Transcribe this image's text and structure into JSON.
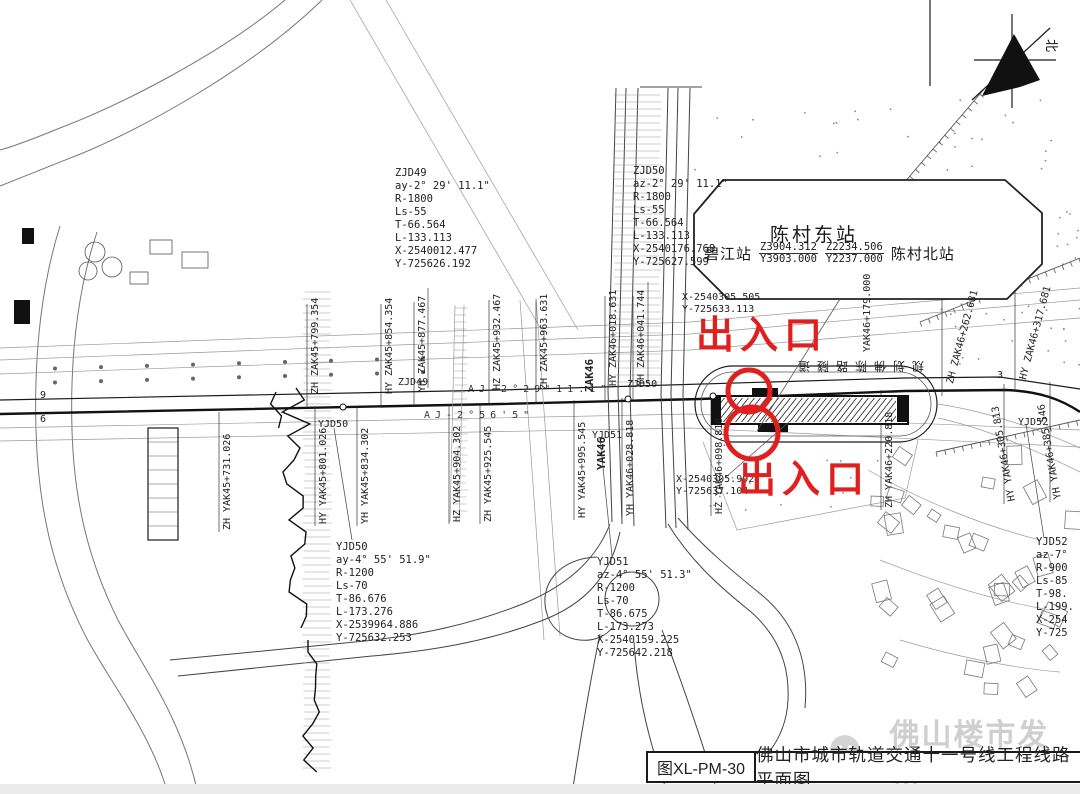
{
  "colors": {
    "annotation_red": "#e01f1f",
    "line_black": "#1a1a1a",
    "watermark_gray": "#c7c7c7"
  },
  "title_block": {
    "drawing_no": "图XL-PM-30",
    "title": "佛山市城市轨道交通十一号线工程线路平面图"
  },
  "watermark": {
    "text": "佛山楼市发布",
    "icon": "wechat-bubbles-icon"
  },
  "north_arrow": {
    "label": "北"
  },
  "station_callout": {
    "main": "陈村东站",
    "left": "碧江站",
    "right": "陈村北站",
    "frac1_num": "Z3904.312",
    "frac1_den": "Y3903.000",
    "frac2_num": "Z2234.506",
    "frac2_den": "Y2237.000"
  },
  "entrances": {
    "top": "出入口",
    "bottom": "出入口"
  },
  "station_annotation": {
    "rotated_text": "规划佛陈路隧道"
  },
  "curve_blocks": [
    {
      "id": "ZJD49",
      "text": "ZJD49\nay-2° 29' 11.1\"\nR-1800\nLs-55\nT-66.564\nL-133.113\nX-2540012.477\nY-725626.192"
    },
    {
      "id": "ZJD50",
      "text": "ZJD50\naz-2° 29' 11.1\"\nR-1800\nLs-55\nT-66.564\nL-133.113\nX-2540176.768\nY-725627.599"
    },
    {
      "id": "YJD50",
      "text": "YJD50\nay-4° 55' 51.9\"\nR-1200\nLs-70\nT-86.676\nL-173.276\nX-2539964.886\nY-725632.253"
    },
    {
      "id": "YJD51",
      "text": "YJD51\naz-4° 55' 51.3\"\nR-1200\nLs-70\nT-86.675\nL-173.273\nX-2540159.225\nY-725642.218"
    },
    {
      "id": "YJD52",
      "text": "YJD52\naz-7°\nR-900\nLs-85\nT-98.\nL-199.\nX-254\nY-725"
    }
  ],
  "chainage_top": [
    "ZH ZAK45+799.354",
    "HY ZAK45+854.354",
    "YH ZAK45+877.467",
    "HZ ZAK45+932.467",
    "ZH ZAK45+963.631",
    "HY ZAK46+018.631",
    "YH ZAK46+041.744",
    "ZH ZAK46+262.681",
    "HY ZAK46+317.681"
  ],
  "chainage_bottom": [
    "ZH YAK45+731.026",
    "HY YAK45+801.026",
    "YH YAK45+834.302",
    "HZ YAK45+904.302",
    "ZH YAK45+925.545",
    "HY YAK45+995.545",
    "YH YAK46+028.818",
    "HZ YAK46+098.818",
    "ZH YAK46+220.818",
    "HY YAK46+305.813",
    "YH YAK46+385.546"
  ],
  "axis_marks": [
    "ZAK46",
    "YAK46"
  ],
  "point_marks": [
    "ZJD49",
    "ZJD50",
    "YJD50",
    "YJD51",
    "YJD52"
  ],
  "angle_marks": [
    "AJ-2°29'11.1\"",
    "AJ-2°56'5\""
  ],
  "coord_marks": [
    "X-2540305.505\nY-725633.113",
    "X-2540305.992\nY-725637.104"
  ],
  "misc_marks": [
    "3",
    "9",
    "6",
    "YAK46+179.000"
  ]
}
